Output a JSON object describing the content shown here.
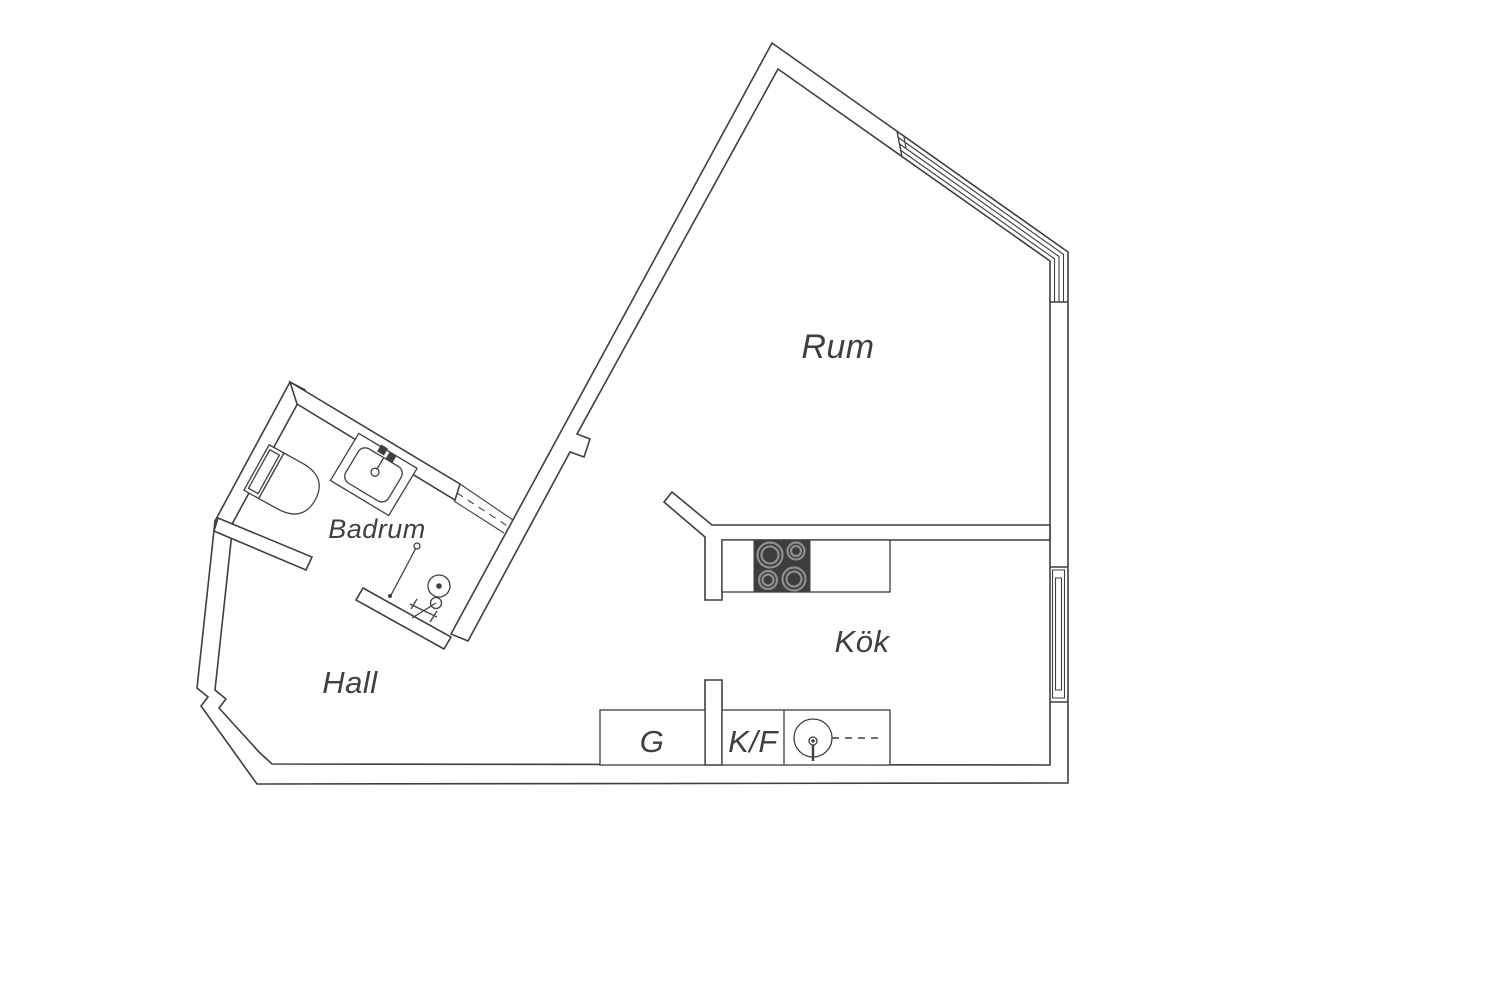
{
  "page": {
    "type": "apartment-floor-plan",
    "background": "#ffffff"
  },
  "colors": {
    "line": "#3f3f3f",
    "stove_fill": "#3d3d3d",
    "burner_ring": "#8f8f8f"
  },
  "rooms": {
    "rum": "Rum",
    "badrum": "Badrum",
    "hall": "Hall",
    "kok": "Kök"
  },
  "kitchen_units": {
    "tall_cabinet": "G",
    "fridge_freezer": "K/F"
  },
  "icons": [
    "toilet-icon",
    "washbasin-icon",
    "shower-icon",
    "stove-icon",
    "kitchen-sink-icon",
    "window-icon"
  ]
}
